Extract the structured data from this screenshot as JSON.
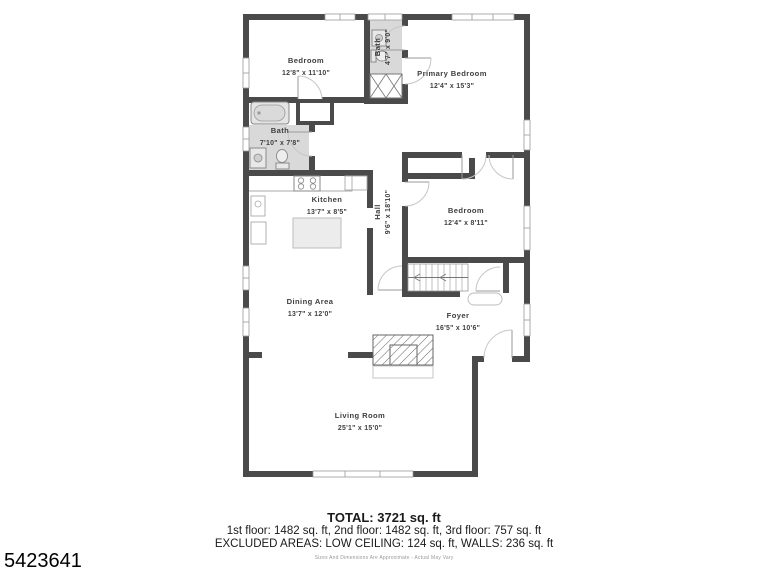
{
  "plan": {
    "rooms": [
      {
        "name": "Bedroom",
        "dims": "12'8\" x 11'10\""
      },
      {
        "name": "Bath",
        "dims": "4'7\" x 9'0\""
      },
      {
        "name": "Primary Bedroom",
        "dims": "12'4\" x 15'3\""
      },
      {
        "name": "Bath",
        "dims": "7'10\" x 7'8\""
      },
      {
        "name": "Kitchen",
        "dims": "13'7\" x 8'5\""
      },
      {
        "name": "Hall",
        "dims": "9'6\" x 18'10\""
      },
      {
        "name": "Bedroom",
        "dims": "12'4\" x 8'11\""
      },
      {
        "name": "Dining Area",
        "dims": "13'7\" x 12'0\""
      },
      {
        "name": "Foyer",
        "dims": "16'5\" x 10'6\""
      },
      {
        "name": "Living Room",
        "dims": "25'1\" x 15'0\""
      }
    ]
  },
  "footer": {
    "total": "TOTAL: 3721 sq. ft",
    "floors": "1st floor: 1482 sq. ft, 2nd floor: 1482 sq. ft, 3rd floor: 757 sq. ft",
    "excluded": "EXCLUDED AREAS: LOW CEILING: 124 sq. ft, WALLS: 236 sq. ft",
    "disclaimer": "Sizes And Dimensions Are Approximate - Actual May Vary"
  },
  "listing_id": "5423641",
  "colors": {
    "wall": "#4a4a4a",
    "bath_fill": "#d9d9d9",
    "label_text": "#3e3e3e",
    "footer_text": "#1a1a1a"
  }
}
